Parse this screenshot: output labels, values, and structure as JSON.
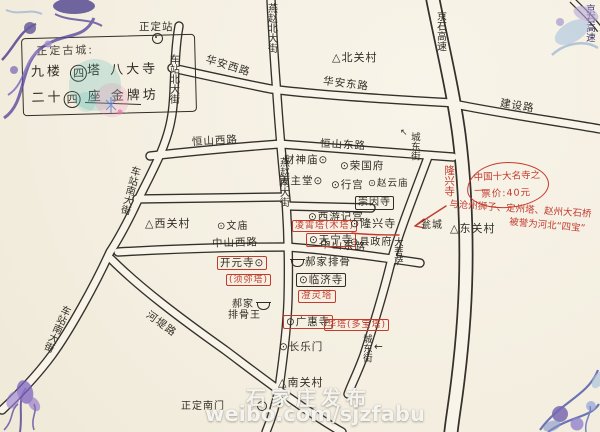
{
  "colors": {
    "paper": "#f4efe1",
    "ink": "#312d26",
    "red_annotation": "#c23b2e",
    "stamp_purple": "#5b4a9e",
    "stamp_blue": "#8aa8d0",
    "stamp_teal": "#4ab8b0",
    "stamp_pink": "#e88fb8"
  },
  "legend_box": {
    "line1": "正定古城:",
    "line2_pre": "九楼",
    "line2_circled": "四",
    "line2_post": "塔 八大寺",
    "line3_pre": "二十",
    "line3_circled": "四",
    "line3_post": "座 金牌坊"
  },
  "station": {
    "label": "正定站"
  },
  "roads": {
    "chezhan_bei": "车站北大街",
    "chezhan_nan_mid": "车站南大街",
    "chezhan_nan_low": "车站南大街",
    "yanzhao_bei": "燕赵北大街",
    "yanzhao_nan": "燕赵南大街",
    "huaan_xi": "华安西路",
    "huaan_dong": "华安东路",
    "hengshan_xi": "恒山西路",
    "hengshan_dong": "恒山东路",
    "zhongshan_xi": "中山西路",
    "zhongshan_dong": "中山东路",
    "jingshi_gaosu": "京石高速",
    "jingshi_gaosu_corner": "京石高速",
    "jianshe": "建设路",
    "hedi": "河堤路",
    "chengdong_bei": "城东街",
    "chengdong_nan": "城东街"
  },
  "villages": {
    "bei": "△北关村",
    "xi": "△西关村",
    "dong": "△东关村",
    "nan": "△南关村"
  },
  "pois": {
    "caishenmiao": "财神庙⊙",
    "tianzhutang": "天主堂⊙",
    "rongguofu": "⊙荣国府",
    "xinggong": "⊙行宫",
    "zhaoyunmiao": "⊙赵云庙",
    "chongyinsi": "崇因寺",
    "xiyoujigong": "⊙西游记宫",
    "tianningsi": "⊙天宁寺",
    "longxingsi": "⊙隆兴寺",
    "xianzhengfu": "⊙县政府",
    "wenmiao": "⊙文庙",
    "kaiyuansi": "开元寺⊙",
    "linjisi": "⊙临济寺",
    "guanghuisi": "⊙广惠寺",
    "changlemen": "⊙长乐门",
    "wengcheng": "瓮城",
    "dapusa": "大菩萨",
    "nanmen": "正定南门"
  },
  "pagodas": {
    "lingxiao": "凌霄塔(木塔)",
    "xumi": "(须弥塔)",
    "chengling": "澄灵塔",
    "huata": "华塔(多宝塔)"
  },
  "red_notes": {
    "longxingsi_vertical": "隆兴寺",
    "bubble_line1": "中国十大名寺之一",
    "bubble_line2": "票价:40元",
    "sibao_line1": "与沧州狮子、定州塔、赵州大石桥",
    "sibao_line2": "被誉为河北“四宝”"
  },
  "restaurants": {
    "haojia": "郝家排骨",
    "haojia_wang_line1": "郝家",
    "haojia_wang_line2": "排骨王"
  },
  "arrows": {
    "chengdong_bei": "↖",
    "chengdong_nan": "←"
  },
  "watermark": {
    "line1": "石家庄发布",
    "line2": "weibo.com/sjzfabu"
  }
}
